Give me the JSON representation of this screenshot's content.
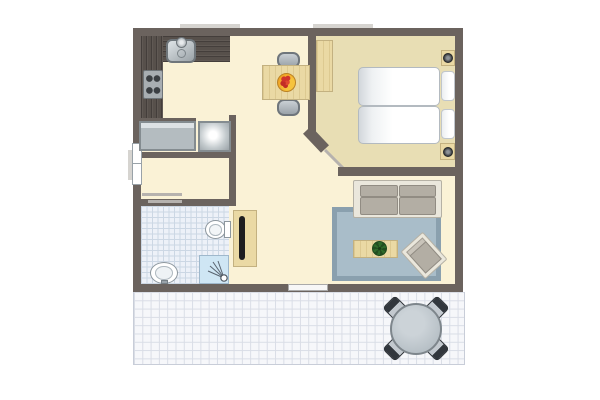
{
  "meta": {
    "title": "Apartment floor plan with terrace",
    "diagram_type": "floor-plan",
    "visible_text": ""
  },
  "colors": {
    "wall": "#6b635e",
    "door_light": "#b6b2ae",
    "floor": "#faf2d6",
    "bedroom_floor": "#e8deb4",
    "counter": "#57504b",
    "wood": "#ead9a4",
    "wood_border": "#c3b180",
    "appliance": "#b4bcc0",
    "rug": "#a9bdc9",
    "rug_border": "#8aa0ae",
    "sofa_frame": "#eae7dc",
    "cushion": "#b3aea4",
    "bath_tile": "#edf1f8",
    "bath_grid": "#ccd7e4",
    "terrace_tile": "#f6f7fa",
    "terrace_grid": "#d9dde6",
    "shower": "#cfe6f4",
    "door_panel": "#1d1d1f",
    "plant": "#2f6b2a",
    "fruit": "#d0342c",
    "bowl": "#f2a93b",
    "patio_table": "#aab4bb",
    "patio_chair": "#32373d"
  },
  "rooms": [
    {
      "name": "kitchen-dining"
    },
    {
      "name": "bedroom"
    },
    {
      "name": "living-area"
    },
    {
      "name": "hallway"
    },
    {
      "name": "storage-room"
    },
    {
      "name": "laundry-niche"
    },
    {
      "name": "bathroom"
    },
    {
      "name": "terrace"
    }
  ],
  "furniture": [
    "kitchen-counter",
    "sink",
    "stove",
    "washing-machine",
    "fridge",
    "dining-table",
    "dining-chair",
    "fruit-bowl",
    "wardrobe",
    "twin-bed",
    "pillow",
    "nightstand",
    "bedside-lamp",
    "sofa",
    "rug",
    "coffee-table",
    "potted-plant",
    "armchair",
    "sliding-door",
    "toilet",
    "washbasin",
    "shower",
    "patio-table",
    "patio-chair"
  ]
}
